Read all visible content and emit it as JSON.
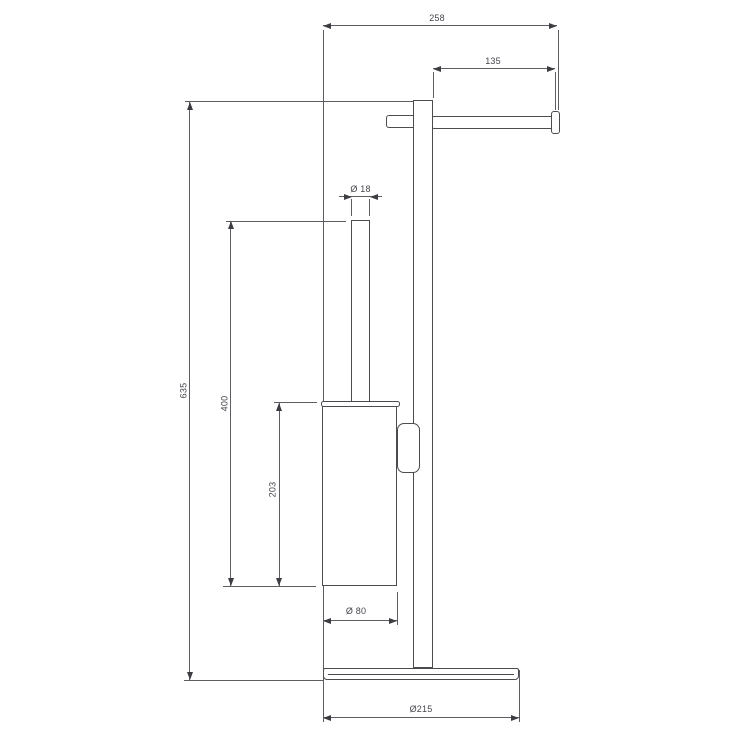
{
  "drawing": {
    "kind": "technical-dimension-drawing",
    "colors": {
      "background": "#ffffff",
      "product_line": "#4b4b50",
      "dimension_line": "#5c5c62",
      "text": "#45454d"
    },
    "dimensions": {
      "overall_width": "258",
      "paper_holder_length": "135",
      "handle_diameter": "Ø 18",
      "overall_height": "635",
      "brush_unit_height": "400",
      "cup_height": "203",
      "cup_diameter": "Ø 80",
      "base_diameter": "Ø215"
    }
  }
}
